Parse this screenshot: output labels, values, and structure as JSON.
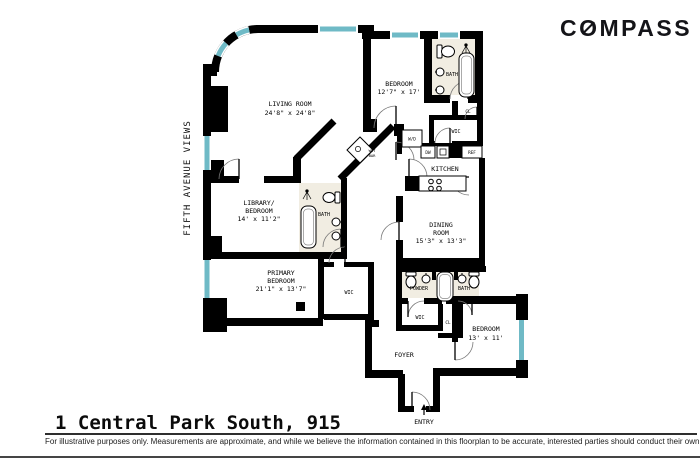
{
  "page": {
    "brand": "COMPASS",
    "title": "1 Central Park South, 915",
    "side_label": "FIFTH AVENUE VIEWS",
    "disclaimer": "For illustrative purposes only.  Measurements are approximate, and while we believe the information contained in this floorplan to be accurate, interested parties should conduct their own inquiries."
  },
  "colors": {
    "wall": "#000000",
    "window_glass": "#6fbac6",
    "bath_floor": "#f1ede2",
    "rule_line": "#2e2e2e"
  },
  "rooms": {
    "living_room": {
      "name": "LIVING ROOM",
      "dims": "24'8\" x 24'8\""
    },
    "bedroom_top": {
      "name": "BEDROOM",
      "dims": "12'7\" x 17'"
    },
    "bath_top": {
      "name": "BATH"
    },
    "closet_top": {
      "name": "CL"
    },
    "wic_top": {
      "name": "WIC"
    },
    "washer_dryer": {
      "name": "W/D"
    },
    "dishwasher": {
      "name": "DW"
    },
    "refrigerator": {
      "name": "REF"
    },
    "kitchen": {
      "name": "KITCHEN"
    },
    "wet_bar": {
      "line1": "WET",
      "line2": "BAR"
    },
    "library_bedroom": {
      "line1": "LIBRARY/",
      "line2": "BEDROOM",
      "dims": "14' x 11'2\""
    },
    "bath_mid": {
      "name": "BATH"
    },
    "dining_room": {
      "line1": "DINING",
      "line2": "ROOM",
      "dims": "15'3\" x 13'3\""
    },
    "primary_bedroom": {
      "line1": "PRIMARY",
      "line2": "BEDROOM",
      "dims": "21'1\" x 13'7\""
    },
    "wic_primary": {
      "name": "WIC"
    },
    "powder": {
      "name": "POWDER"
    },
    "bath_bottom": {
      "name": "BATH"
    },
    "wic_bottom": {
      "name": "WIC"
    },
    "closet_bottom": {
      "name": "CL"
    },
    "bedroom_bottom": {
      "name": "BEDROOM",
      "dims": "13' x 11'"
    },
    "foyer": {
      "name": "FOYER"
    },
    "entry": {
      "name": "ENTRY"
    }
  }
}
